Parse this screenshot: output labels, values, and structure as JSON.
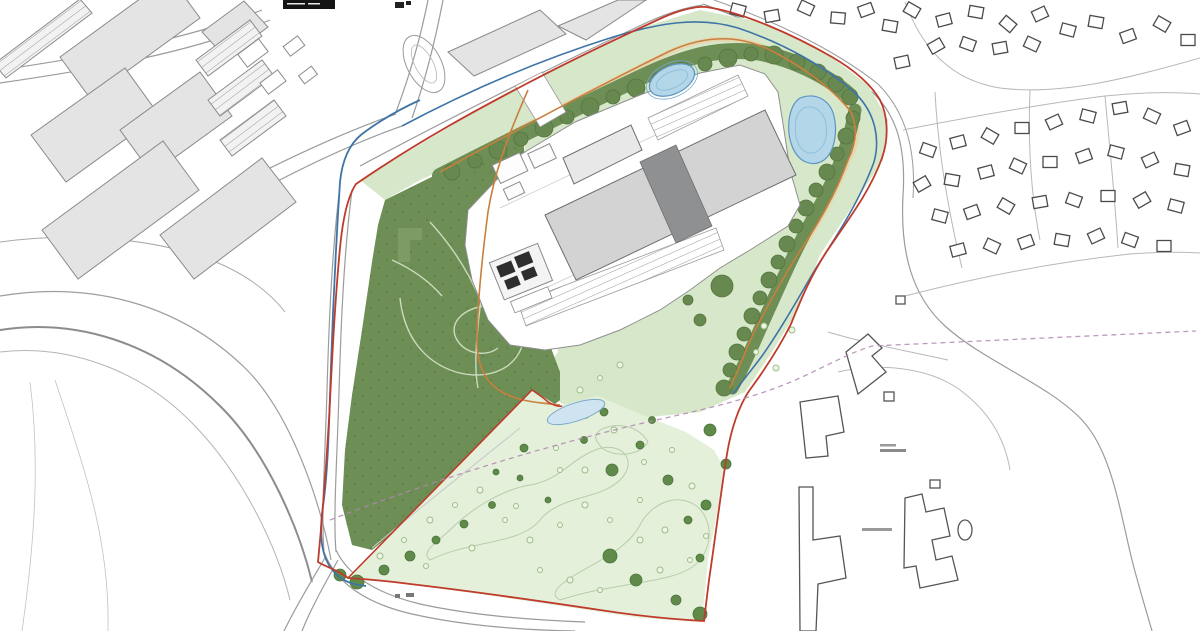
{
  "canvas": {
    "width": 1200,
    "height": 631,
    "background": "#ffffff"
  },
  "map": {
    "type": "site-masterplan-drawing",
    "features": [
      "title-block",
      "industrial-estate",
      "access-roads",
      "oval-track",
      "residential-area",
      "farm-buildings",
      "woodland",
      "landscape-verge",
      "tree-belt",
      "parkland-field",
      "scattered-trees",
      "attenuation-pond-west",
      "attenuation-pond-east",
      "field-pond",
      "development-platform",
      "warehouse-unit-west",
      "warehouse-unit-east",
      "central-spine",
      "dock-parking-rows",
      "service-structures",
      "red-line-boundary",
      "blue-line",
      "orange-footpath",
      "public-footpath-dashed",
      "contour-lines",
      "map-labels"
    ]
  },
  "palette": {
    "background": "#ffffff",
    "red_line": "#bf3b2b",
    "blue_line": "#3f74a6",
    "orange_route": "#c97f3e",
    "purple_path": "#b287b2",
    "woodland": "#6d8e55",
    "tree": "#5f8a4a",
    "tree_stroke": "#4c743a",
    "tree_small": "#9dbd87",
    "verge_green": "#d7e8ca",
    "field_green": "#e5f0db",
    "field_line": "#b7cda9",
    "pond_fill": "#b3d6e9",
    "pond_stroke": "#5d95c0",
    "pond_pale": "#cfe4f0",
    "building_fill": "#d3d3d3",
    "building_stroke": "#6e6e6e",
    "building_spine": "#8e9092",
    "existing_fill": "#e4e4e4",
    "existing_stroke": "#8a8a8a",
    "house_stroke": "#4a4a4a",
    "road_line": "#9b9b9b",
    "contour_line": "#a9a9a9",
    "path_tan": "#e5d7b0",
    "title_block_bg": "#141414"
  }
}
